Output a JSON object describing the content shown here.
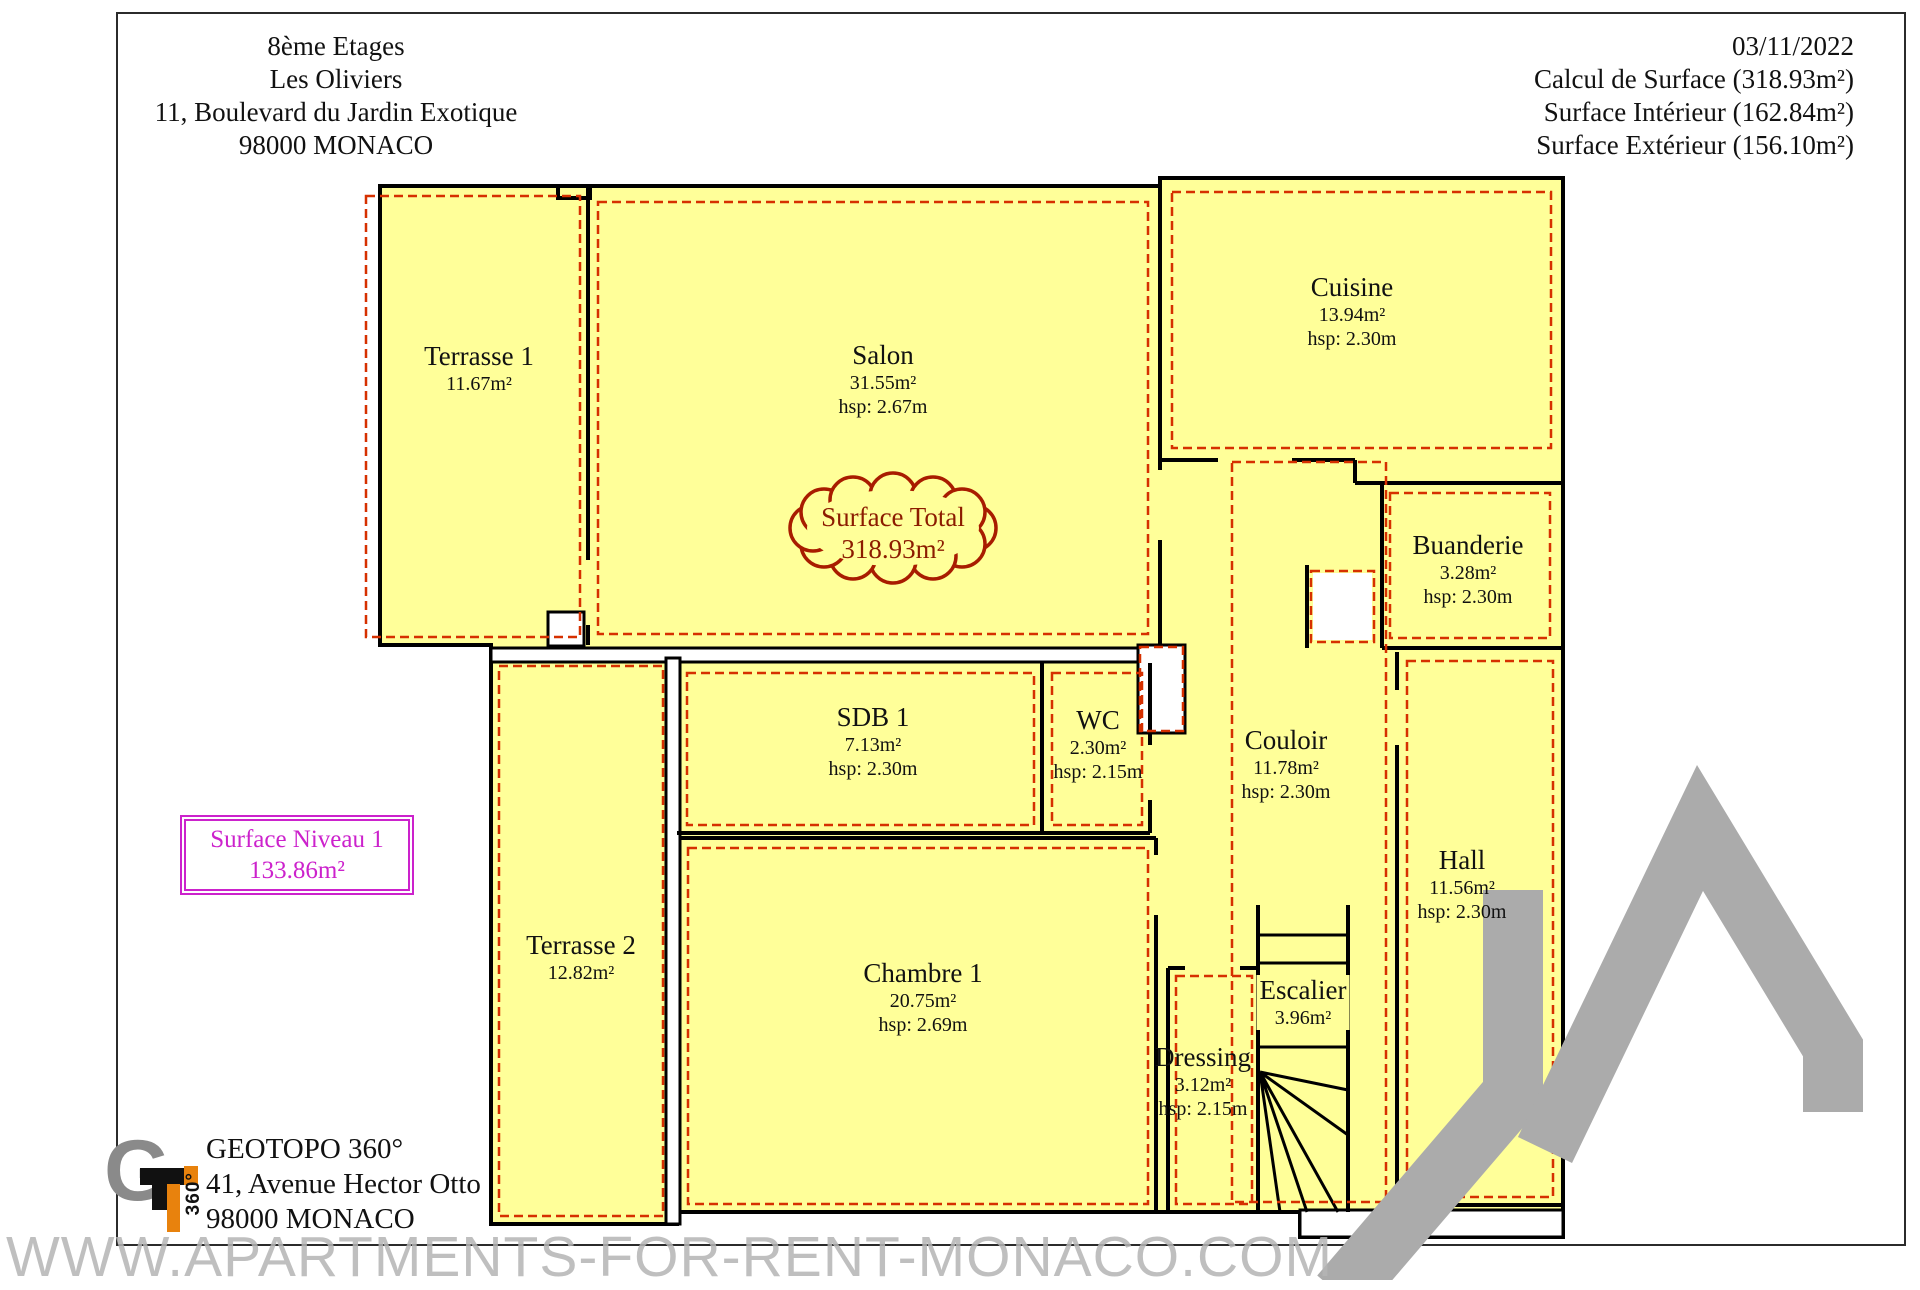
{
  "header_left": {
    "lines": [
      "8ème Etages",
      "Les Oliviers",
      "11, Boulevard du Jardin Exotique",
      "98000 MONACO"
    ]
  },
  "header_right": {
    "lines": [
      "03/11/2022",
      "Calcul de Surface (318.93m²)",
      "Surface Intérieur (162.84m²)",
      "Surface Extérieur (156.10m²)"
    ]
  },
  "surface_total": {
    "line1": "Surface Total",
    "line2": "318.93m²"
  },
  "surface_niveau": {
    "line1": "Surface Niveau 1",
    "line2": "133.86m²"
  },
  "rooms": {
    "terrasse1": {
      "name": "Terrasse 1",
      "area": "11.67m²"
    },
    "salon": {
      "name": "Salon",
      "area": "31.55m²",
      "hsp": "hsp: 2.67m"
    },
    "cuisine": {
      "name": "Cuisine",
      "area": "13.94m²",
      "hsp": "hsp: 2.30m"
    },
    "buanderie": {
      "name": "Buanderie",
      "area": "3.28m²",
      "hsp": "hsp: 2.30m"
    },
    "sdb1": {
      "name": "SDB 1",
      "area": "7.13m²",
      "hsp": "hsp: 2.30m"
    },
    "wc": {
      "name": "WC",
      "area": "2.30m²",
      "hsp": "hsp: 2.15m"
    },
    "couloir": {
      "name": "Couloir",
      "area": "11.78m²",
      "hsp": "hsp: 2.30m"
    },
    "hall": {
      "name": "Hall",
      "area": "11.56m²",
      "hsp": "hsp: 2.30m"
    },
    "terrasse2": {
      "name": "Terrasse 2",
      "area": "12.82m²"
    },
    "chambre1": {
      "name": "Chambre 1",
      "area": "20.75m²",
      "hsp": "hsp: 2.69m"
    },
    "escalier": {
      "name": "Escalier",
      "area": "3.96m²"
    },
    "dressing": {
      "name": "Dressing",
      "area": "3.12m²",
      "hsp": "hsp: 2.15m"
    }
  },
  "logo": {
    "mark_letter": "G",
    "mark_360": "360°",
    "name": "GEOTOPO 360°",
    "address": "41, Avenue Hector Otto",
    "city": "98000 MONACO"
  },
  "watermark": {
    "text": "WWW.APARTMENTS-FOR-RENT-MONACO.COM"
  },
  "colors": {
    "room_fill": "#FFFF99",
    "wall": "#000000",
    "surface_dash": "#D63000",
    "cloud_stroke": "#A81C00",
    "cloud_text": "#8C1C00",
    "niveau_magenta": "#CC22CC",
    "watermark_gray": "#ABABAB",
    "logo_orange": "#E8820D",
    "logo_gray": "#8A8A8A"
  }
}
